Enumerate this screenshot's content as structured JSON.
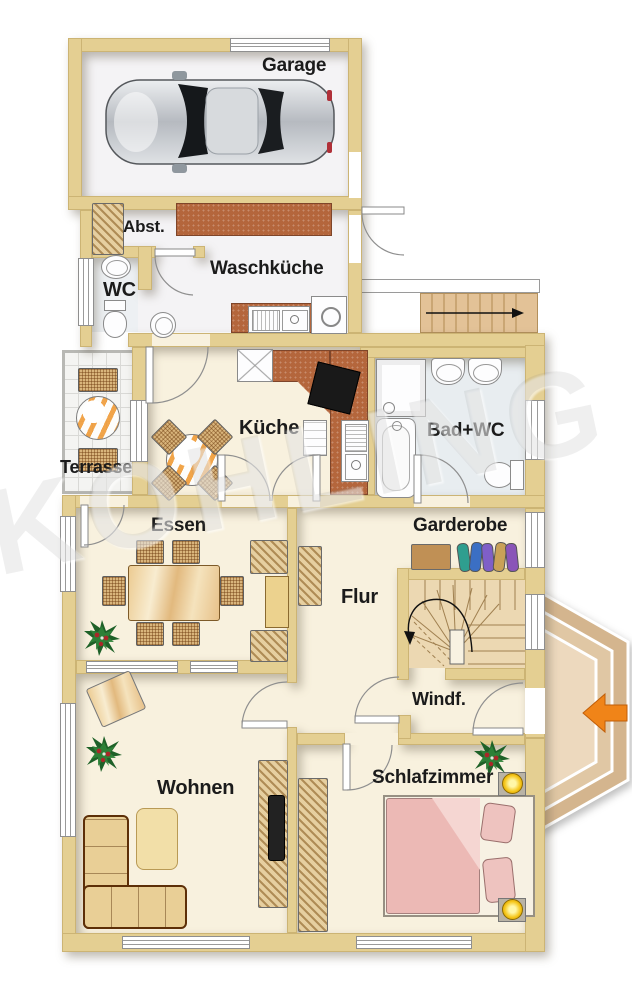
{
  "watermark": {
    "text": "KOHLING"
  },
  "rooms": {
    "garage": {
      "label": "Garage"
    },
    "abstellraum": {
      "label": "Abst."
    },
    "wc": {
      "label": "WC"
    },
    "waschkueche": {
      "label": "Waschküche"
    },
    "terrasse": {
      "label": "Terrasse"
    },
    "kueche": {
      "label": "Küche"
    },
    "bad_wc": {
      "label": "Bad+WC"
    },
    "essen": {
      "label": "Essen"
    },
    "garderobe": {
      "label": "Garderobe"
    },
    "flur": {
      "label": "Flur"
    },
    "windfang": {
      "label": "Windf."
    },
    "wohnen": {
      "label": "Wohnen"
    },
    "schlafzimmer": {
      "label": "Schlafzimmer"
    }
  },
  "colors": {
    "wall": "#e4cf92",
    "floor_living": "#f8f1de",
    "floor_utility": "#f4f3f5",
    "floor_bath": "#e8edf0",
    "counter": "#b4663c",
    "bed": "#ecb9b5",
    "entrance_arrow": "#f08418"
  },
  "icons": [
    "car-top-view",
    "washing-machine",
    "laundry-sink",
    "wc-toilet",
    "wc-basin",
    "pedestal-basin",
    "kitchen-counter",
    "cooktop",
    "kitchen-sink",
    "round-dining-table",
    "terrace-table",
    "shower",
    "double-basin",
    "bathtub",
    "toilet",
    "dining-table",
    "chairs",
    "coat-hooks",
    "bench",
    "winding-staircase",
    "exterior-stairs",
    "corner-sofa",
    "armchair",
    "coffee-table",
    "tv-cabinet",
    "wardrobe",
    "double-bed",
    "pillows",
    "bedside-lamp",
    "plant",
    "direction-arrow",
    "entrance-arrow"
  ]
}
